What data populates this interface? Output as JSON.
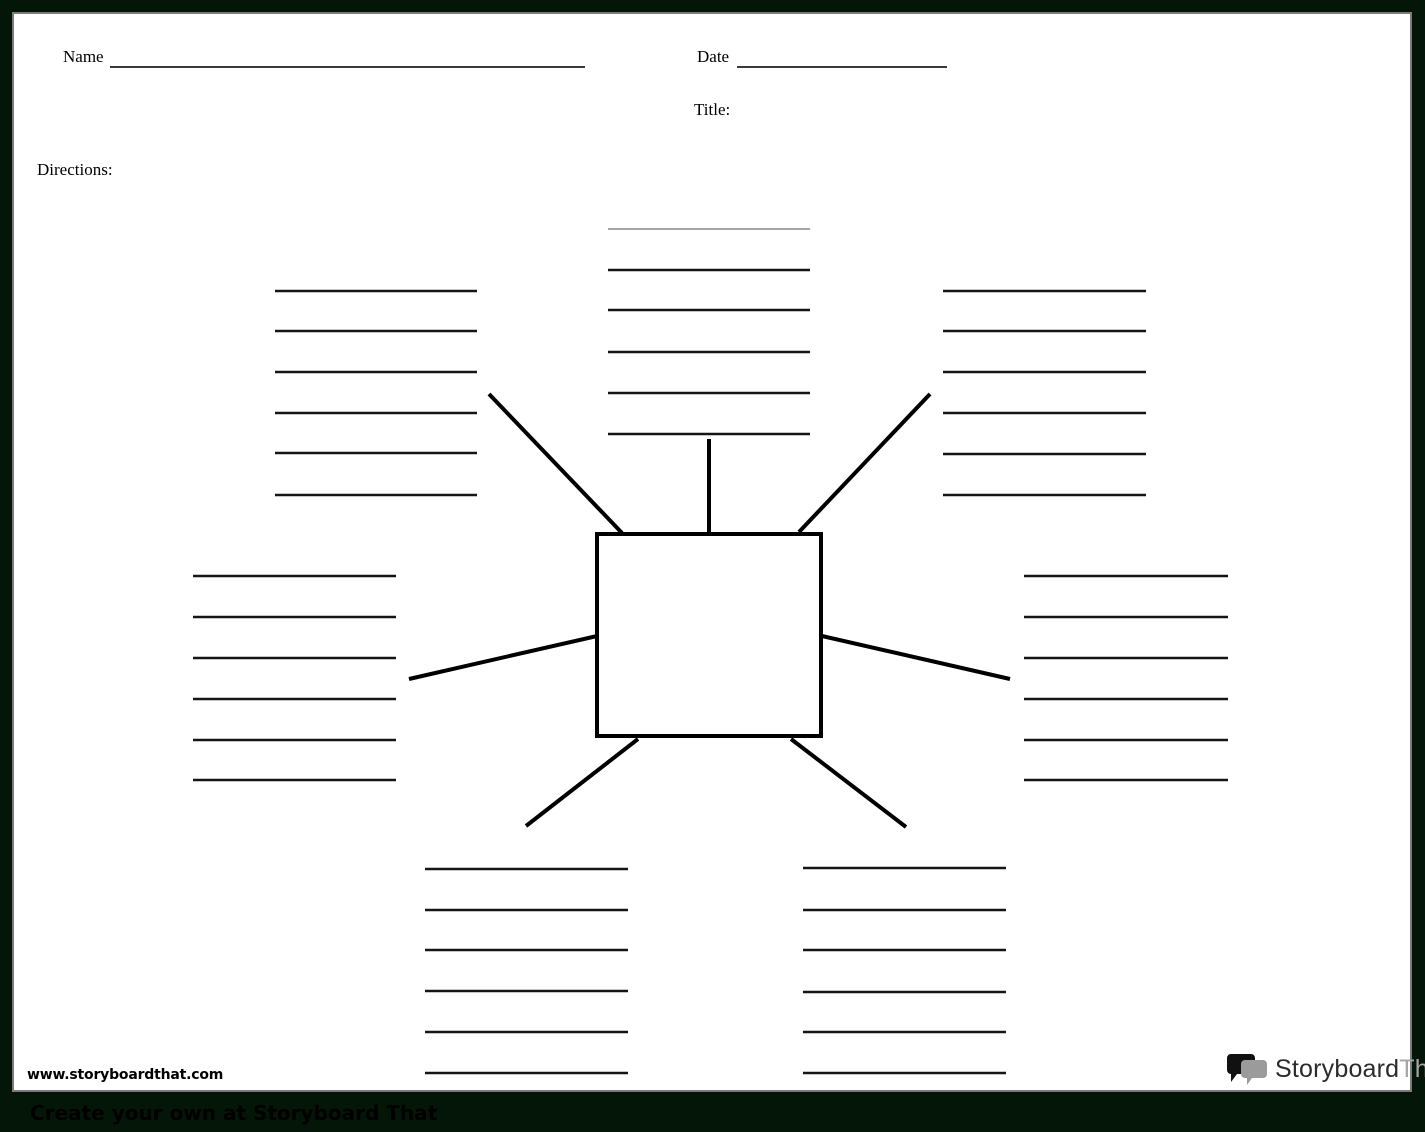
{
  "header": {
    "name_label": "Name",
    "date_label": "Date",
    "title_label": "Title:",
    "directions_label": "Directions:"
  },
  "footer": {
    "website_url": "www.storyboardthat.com",
    "logo": {
      "icon": "speech-bubbles-icon",
      "text_primary": "Storyboard",
      "text_secondary": "That"
    },
    "banner_text": "Create your own at Storyboard That"
  },
  "colors": {
    "frame_background": "#041607",
    "page_background": "#ffffff",
    "page_border": "#7b7b7b",
    "ink": "#151515",
    "light_line": "#8a8a8a",
    "logo_secondary": "#a6a6a6"
  },
  "diagram": {
    "type": "spider-map",
    "center_shape": "rectangle",
    "center_box": {
      "x": 583,
      "y": 520,
      "width": 224,
      "height": 202,
      "stroke_width": 4
    },
    "branch_count": 7,
    "lines_per_cluster": 6,
    "connectors": [
      {
        "name": "connector-top-left",
        "x1": 608,
        "y1": 519,
        "x2": 475,
        "y2": 380
      },
      {
        "name": "connector-top-center",
        "x1": 695,
        "y1": 519,
        "x2": 695,
        "y2": 425
      },
      {
        "name": "connector-top-right",
        "x1": 785,
        "y1": 518,
        "x2": 916,
        "y2": 380
      },
      {
        "name": "connector-mid-left",
        "x1": 583,
        "y1": 622,
        "x2": 395,
        "y2": 665
      },
      {
        "name": "connector-mid-right",
        "x1": 808,
        "y1": 622,
        "x2": 996,
        "y2": 665
      },
      {
        "name": "connector-bottom-left",
        "x1": 624,
        "y1": 725,
        "x2": 512,
        "y2": 812
      },
      {
        "name": "connector-bottom-right",
        "x1": 777,
        "y1": 725,
        "x2": 892,
        "y2": 813
      }
    ],
    "clusters": [
      {
        "name": "cluster-top-center",
        "x1": 594,
        "x2": 796,
        "ys": [
          215,
          256,
          296,
          338,
          379,
          420
        ],
        "light_first_line": true
      },
      {
        "name": "cluster-top-left",
        "x1": 261,
        "x2": 463,
        "ys": [
          277,
          317,
          358,
          399,
          439,
          481
        ],
        "light_first_line": false
      },
      {
        "name": "cluster-top-right",
        "x1": 929,
        "x2": 1132,
        "ys": [
          277,
          317,
          358,
          399,
          440,
          481
        ],
        "light_first_line": false
      },
      {
        "name": "cluster-mid-left",
        "x1": 179,
        "x2": 382,
        "ys": [
          562,
          603,
          644,
          685,
          726,
          766
        ],
        "light_first_line": false
      },
      {
        "name": "cluster-mid-right",
        "x1": 1010,
        "x2": 1214,
        "ys": [
          562,
          603,
          644,
          685,
          726,
          766
        ],
        "light_first_line": false
      },
      {
        "name": "cluster-bottom-left",
        "x1": 411,
        "x2": 614,
        "ys": [
          855,
          896,
          936,
          977,
          1018,
          1059
        ],
        "light_first_line": false
      },
      {
        "name": "cluster-bottom-right",
        "x1": 789,
        "x2": 992,
        "ys": [
          854,
          896,
          936,
          978,
          1018,
          1059
        ],
        "light_first_line": false
      }
    ]
  }
}
